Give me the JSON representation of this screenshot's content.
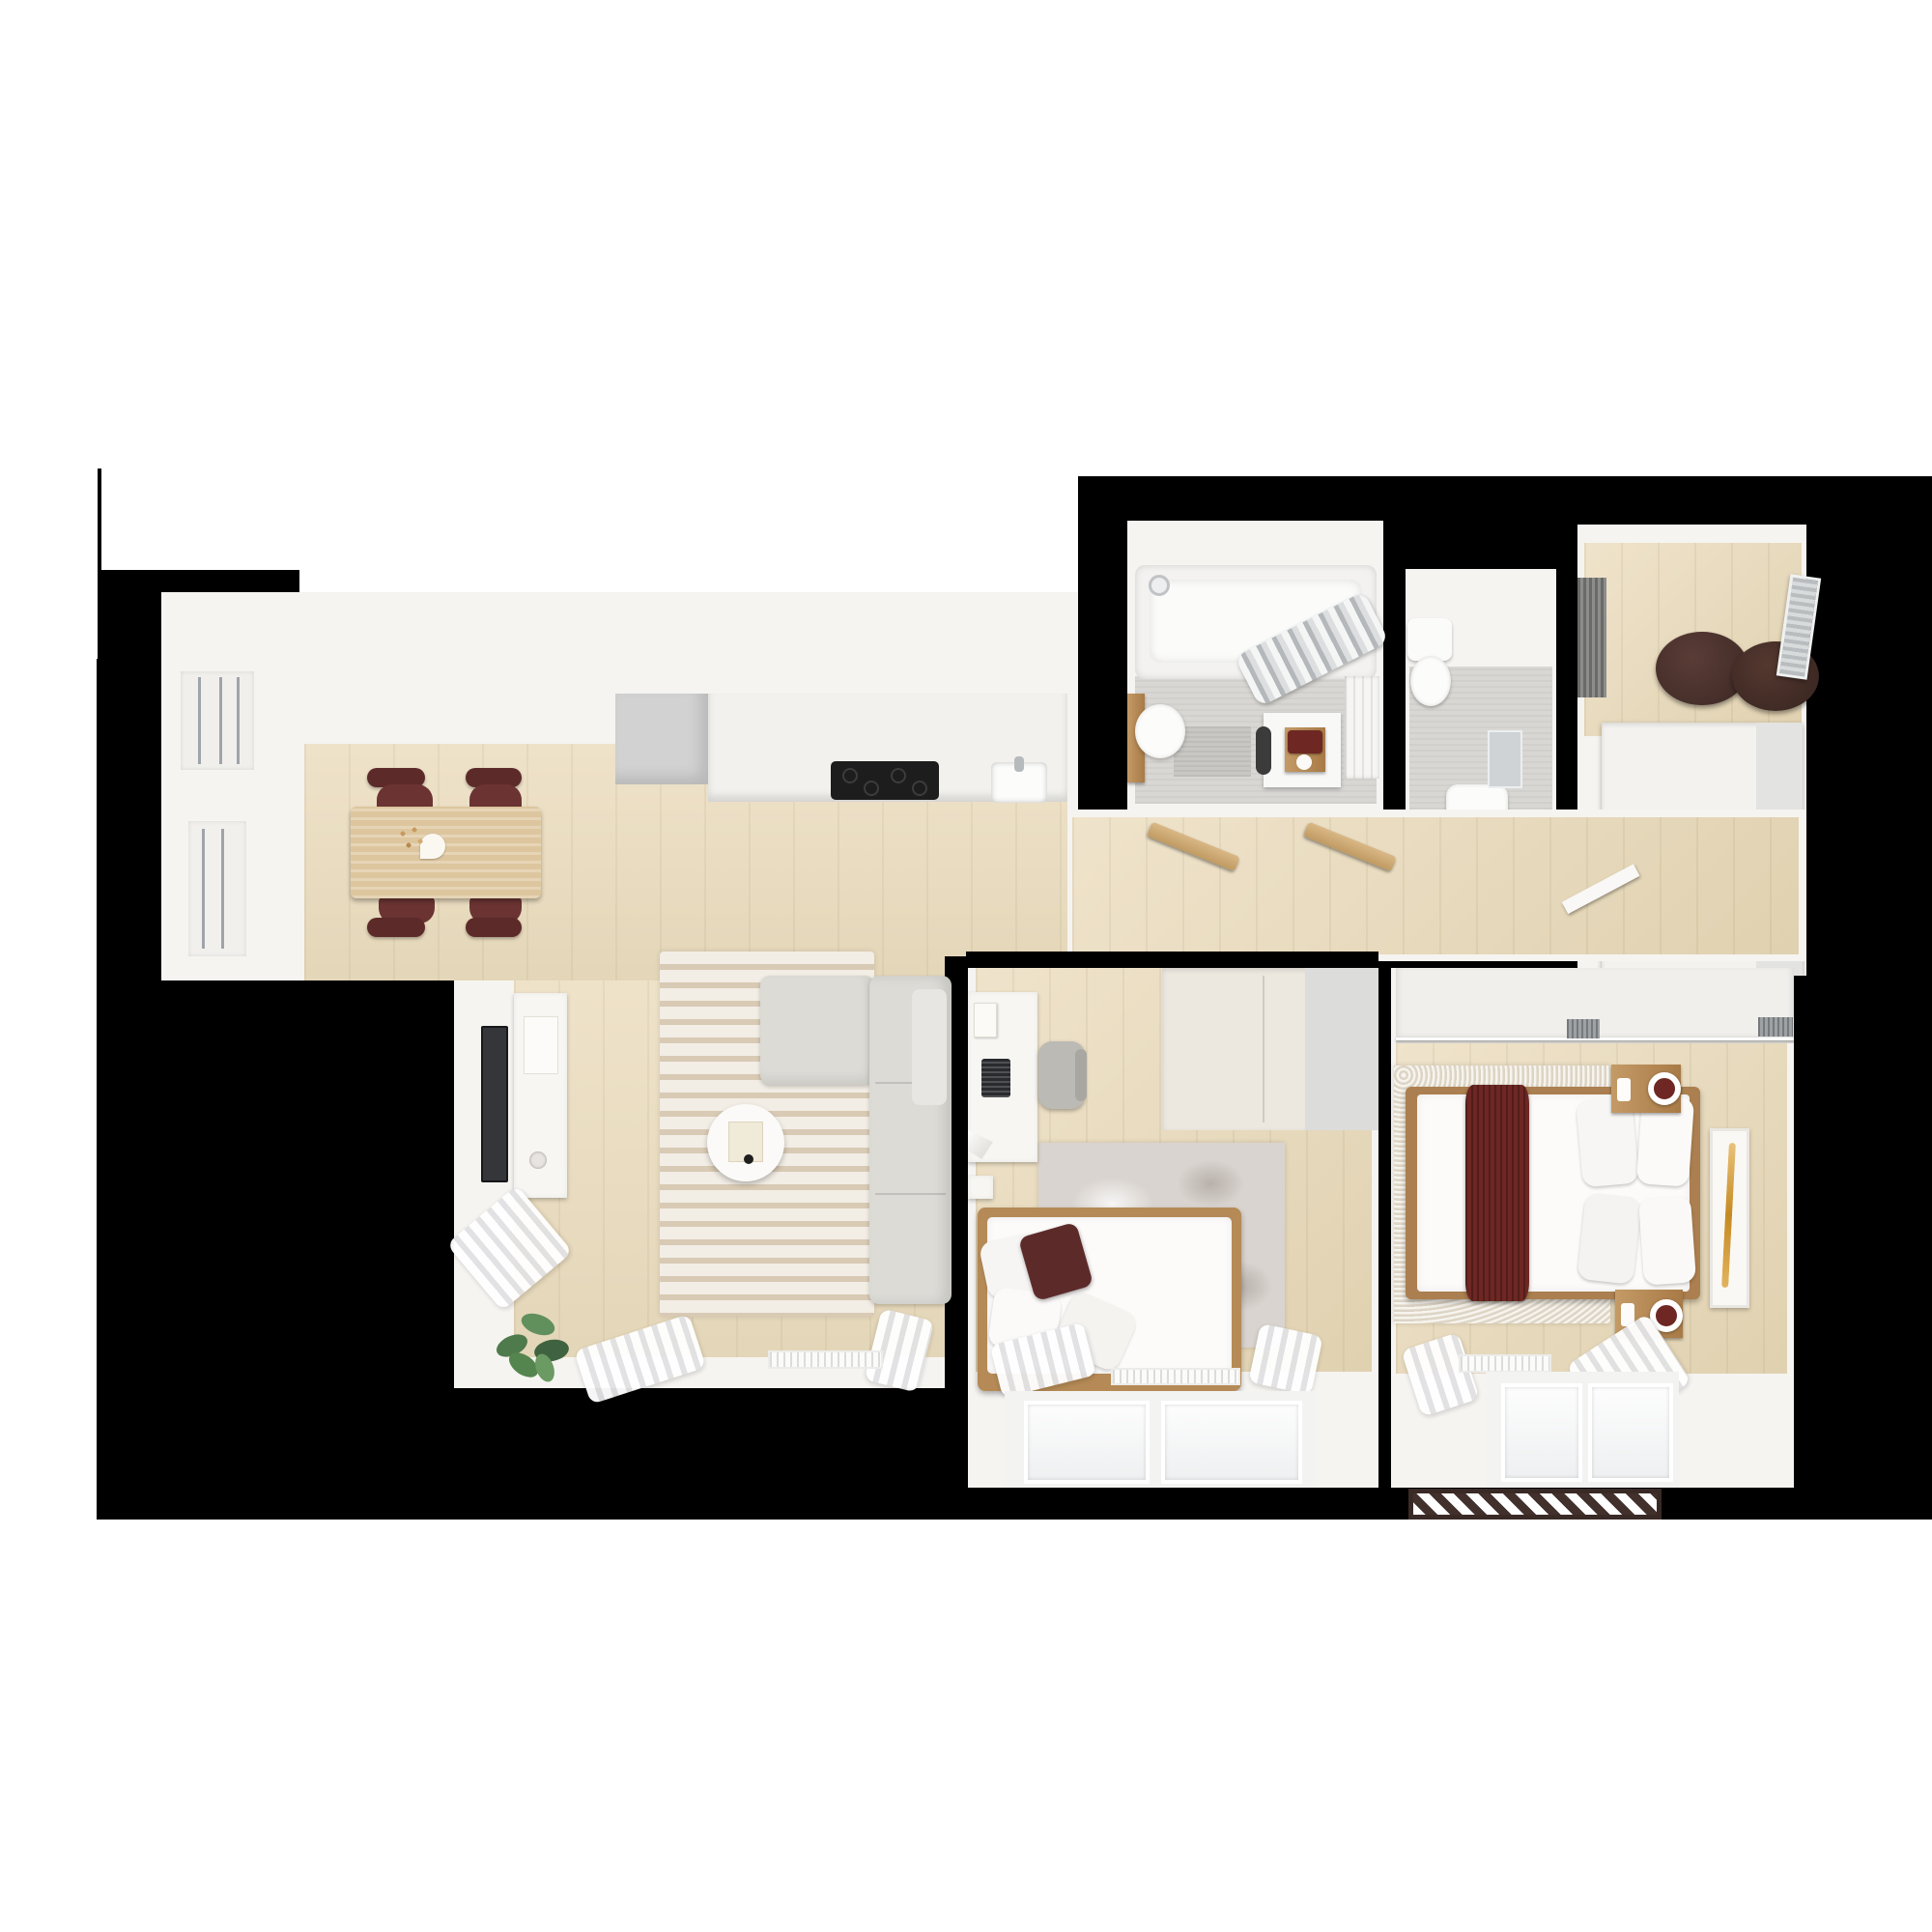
{
  "scene": {
    "description": "3D rendered top-down floor plan of a two-bedroom apartment on a black cut-out mask over a white canvas",
    "style": "photoreal dollhouse top view, no text labels",
    "background_color": "#ffffff",
    "mask_color": "#000000"
  },
  "palette": {
    "canvas_white": "#ffffff",
    "mask_black": "#000000",
    "wall_white": "#f6f4f1",
    "oak_floor": "#e9ddc2",
    "oak_table": "#ddc69e",
    "gray_appliance": "#d2d2d2",
    "cooktop_black": "#1d1d1d",
    "sofa_gray": "#dcdbd6",
    "rug_stripe_light": "#f2ede5",
    "rug_stripe_dark": "#d8cab4",
    "kids_rug_gray": "#d9d4cf",
    "bedroom_rug_cream": "#eae3d5",
    "burgundy_accent": "#5d2a2a",
    "burgundy_chair": "#6b3433",
    "burgundy_runner": "#6e2723",
    "pouf_brown": "#45302b",
    "wood_furniture": "#b58a56",
    "bath_floor_gray": "#d9d7d3",
    "chrome_curtain": "#c3c6c9",
    "plant_green": "#4f7a4c",
    "art_amber": "#d9a33c",
    "doormat_stripe": "#42302c"
  },
  "rooms": [
    {
      "name": "dining-area",
      "furniture": [
        "dining-table",
        "vase-with-flowers",
        "dining-chair x4 (burgundy)",
        "balcony-door",
        "window"
      ]
    },
    {
      "name": "kitchen",
      "furniture": [
        "tall-fridge-unit",
        "counter-run",
        "induction-cooktop",
        "sink"
      ]
    },
    {
      "name": "living-room",
      "furniture": [
        "wall-tv",
        "media-console",
        "striped-rug",
        "l-shaped-sofa",
        "round-coffee-table",
        "potted-plant",
        "curtains",
        "radiator",
        "windows"
      ]
    },
    {
      "name": "bathroom",
      "furniture": [
        "bathtub-with-shower",
        "chrome-shower-curtain",
        "pedestal-basin",
        "wood-cabinet",
        "washing-machine",
        "towel-tray (burgundy towels)",
        "paneled-door",
        "bath-mat"
      ]
    },
    {
      "name": "wc",
      "furniture": [
        "toilet",
        "hand-basin",
        "mirror"
      ]
    },
    {
      "name": "entry-wardrobe-room",
      "furniture": [
        "shoe-mat",
        "pouf x2 (dark brown)",
        "leaning-mirror",
        "large-white-wardrobe"
      ]
    },
    {
      "name": "hallway",
      "furniture": [
        "open-door-leaf x2"
      ]
    },
    {
      "name": "kids-room",
      "furniture": [
        "desk",
        "book",
        "laptop",
        "desk-lamp",
        "desk-chair",
        "small-shelf",
        "wardrobe",
        "distressed-rug",
        "single-bed",
        "pillows",
        "burgundy-cushion",
        "curtains",
        "radiator",
        "window"
      ]
    },
    {
      "name": "bedroom",
      "furniture": [
        "sliding-closet",
        "loop-pile-rug",
        "double-bed",
        "burgundy-runner",
        "pillows x4",
        "nightstand x2",
        "ring-lamp x2",
        "wall-art (amber)",
        "curtains",
        "radiator",
        "window",
        "striped-doormat"
      ]
    }
  ]
}
